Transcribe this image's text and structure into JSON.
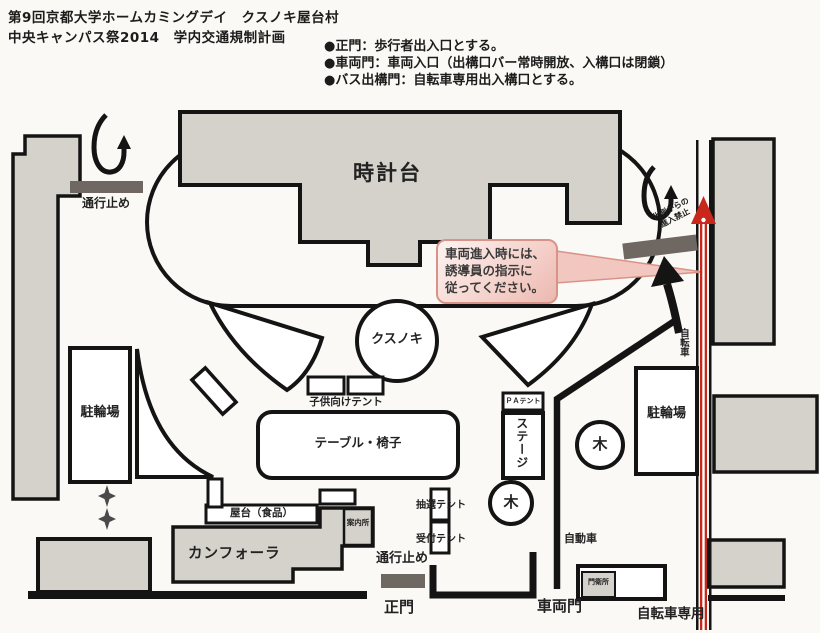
{
  "title": {
    "line1": "第9回京都大学ホームカミングデイ　クスノキ屋台村",
    "line2": "中央キャンパス祭2014　学内交通規制計画"
  },
  "legend": {
    "items": [
      "●正門：歩行者出入口とする。",
      "●車両門：車両入口（出構口バー常時開放、入構口は閉鎖）",
      "●バス出構門：自転車専用出入構口とする。"
    ]
  },
  "callout": {
    "line1": "車両進入時には、",
    "line2": "誘導員の指示に",
    "line3": "従ってください。"
  },
  "map": {
    "clock_tower": "時計台",
    "road_closed_top": "通行止め",
    "road_closed_bottom": "通行止め",
    "no_entry_north_line1": "北側からの",
    "no_entry_north_line2": "進入禁止",
    "kusunoki": "クスノキ",
    "kids_tent": "子供向けテント",
    "table_chairs": "テーブル・椅子",
    "bike_parking_left": "駐輪場",
    "bike_parking_right": "駐輪場",
    "pa_tent": "ＰＡテント",
    "stage": "ステージ",
    "tree1": "木",
    "tree2": "木",
    "lottery_tent": "抽選テント",
    "reception_tent": "受付テント",
    "food_stalls": "屋台（食品）",
    "info_desk": "案内所",
    "camphora": "カンフォーラ",
    "main_gate": "正門",
    "vehicle_gate": "車両門",
    "gate_guard": "門衛所",
    "car": "自動車",
    "bicycle": "自転車",
    "bicycle_only": "自転車専用"
  },
  "colors": {
    "paper": "#faf9f5",
    "building_fill": "#d4d2ca",
    "line_black": "#141414",
    "barrier_bar": "#6f6761",
    "bicycle_route_red": "#c8281c",
    "callout_fill": "#f3cbc4",
    "callout_border": "#d89388"
  }
}
